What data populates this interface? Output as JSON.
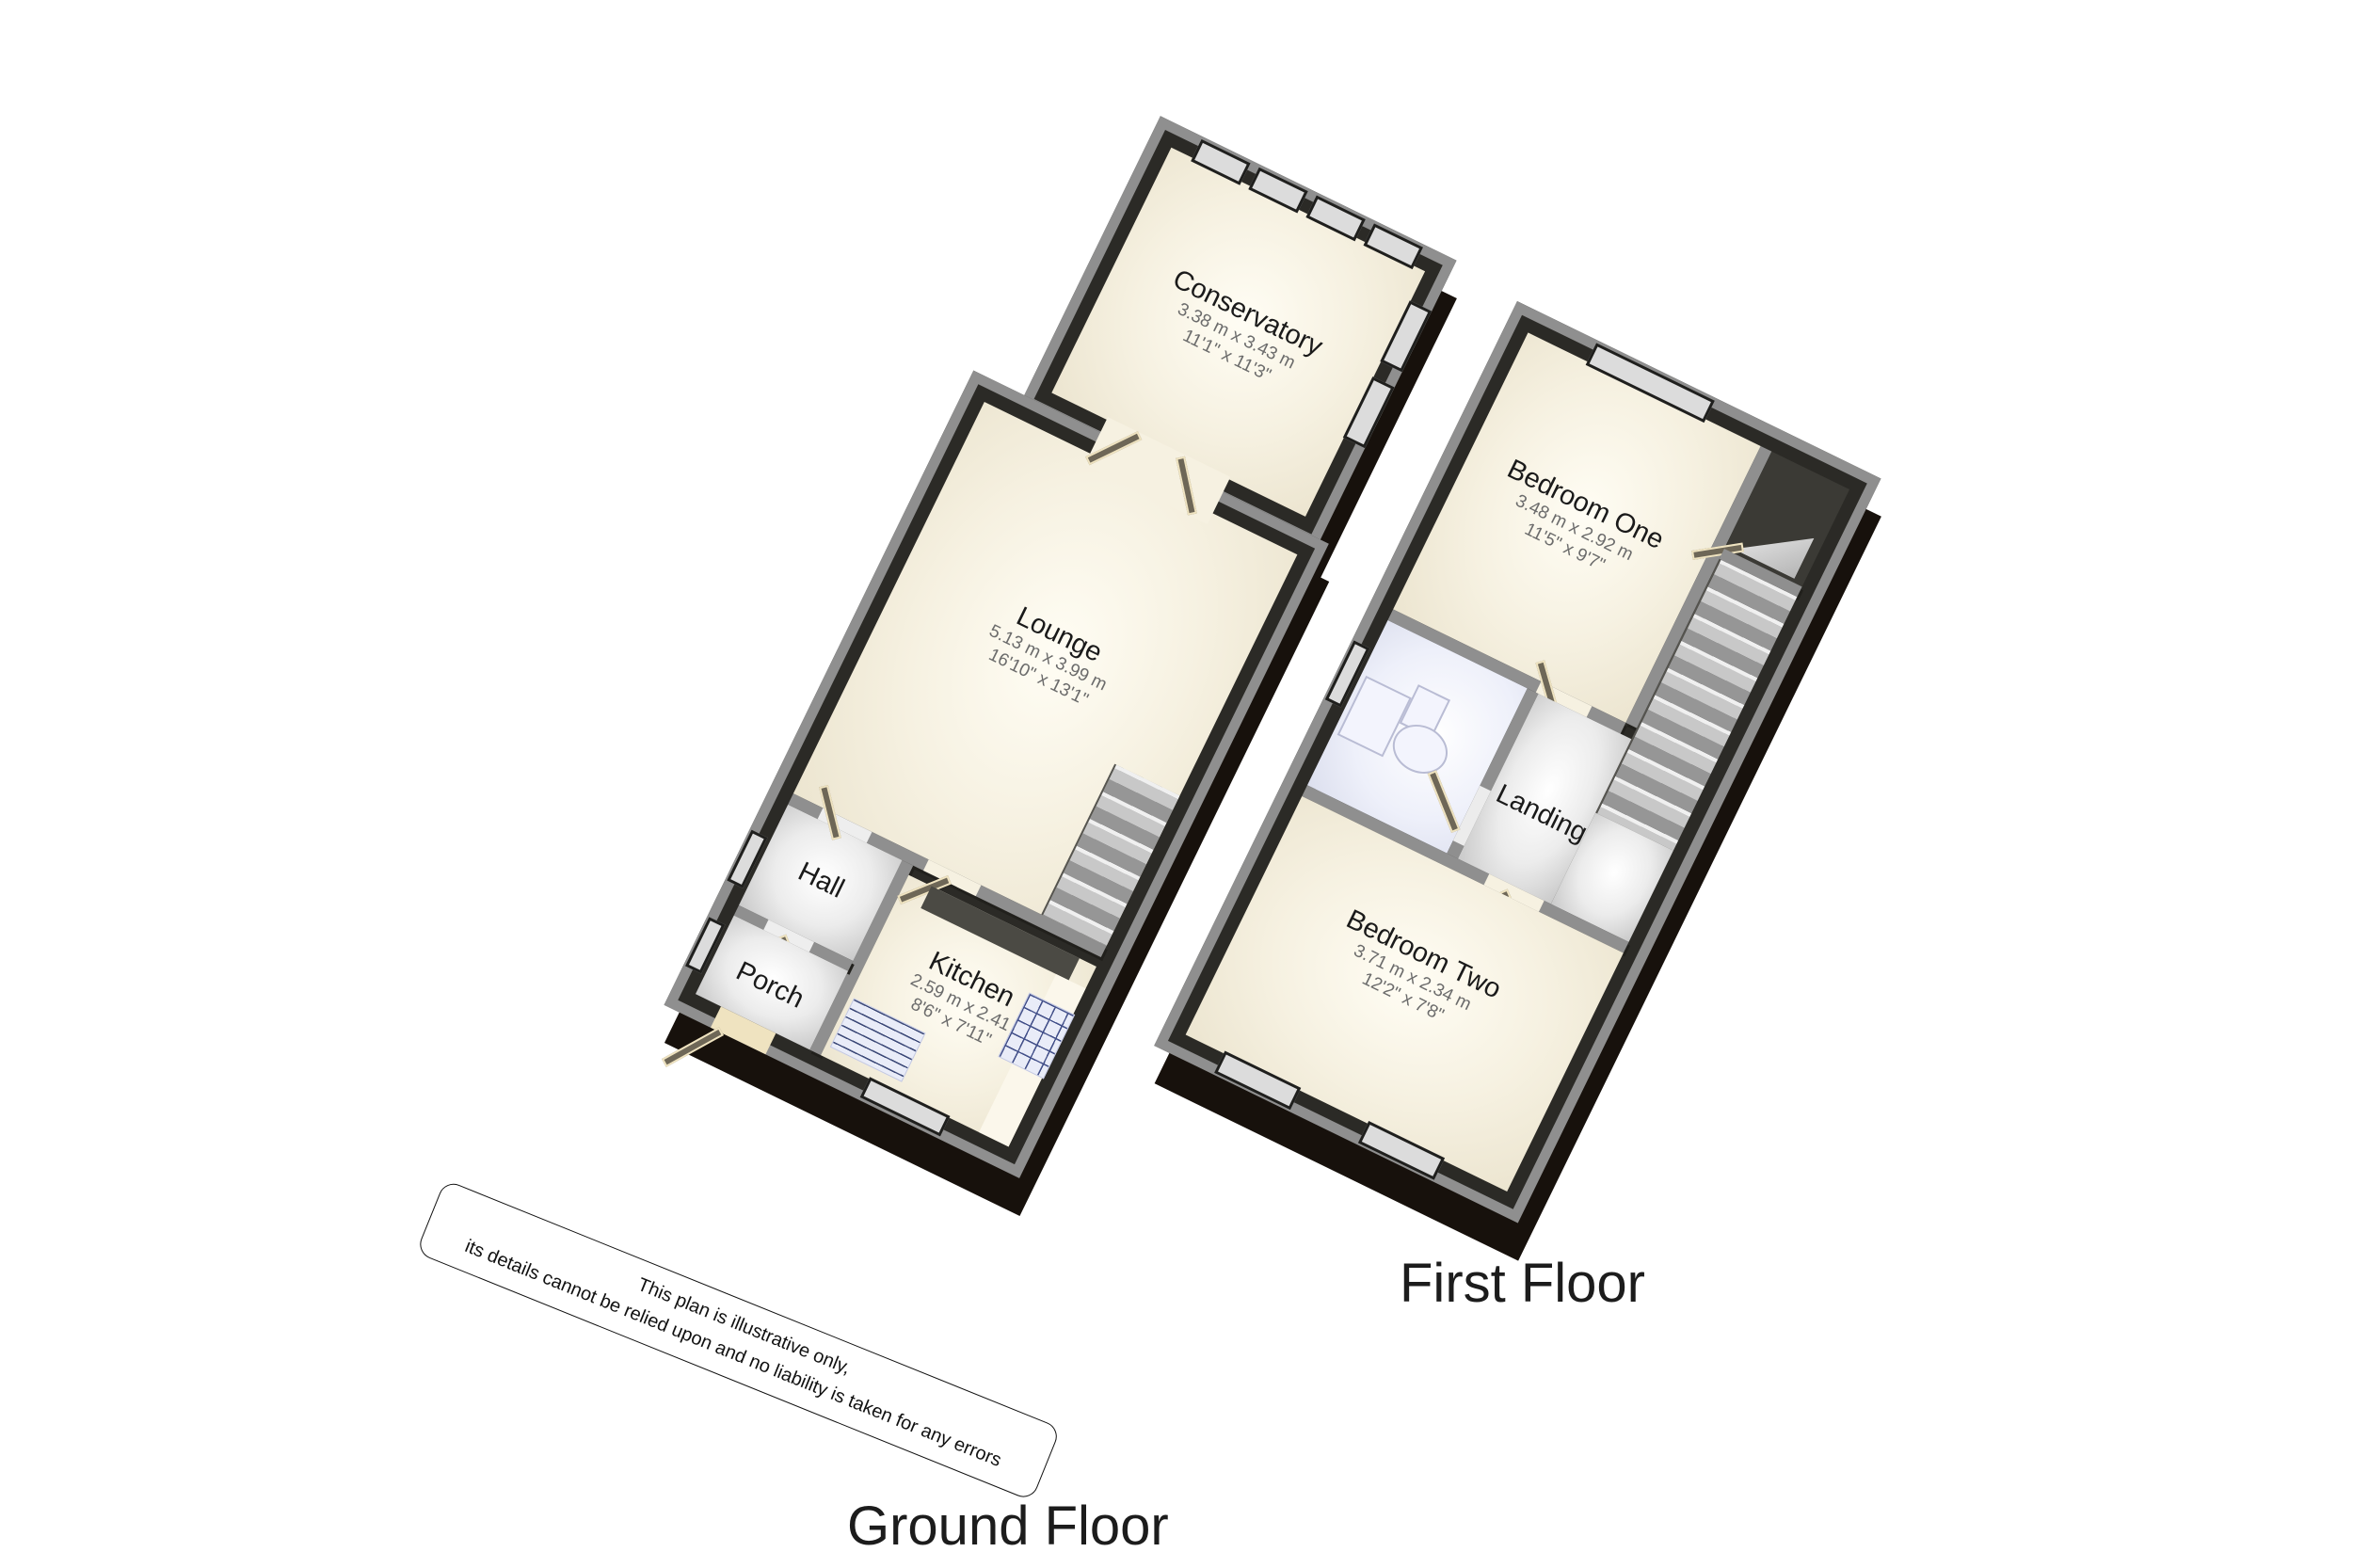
{
  "floors": {
    "ground": {
      "caption": "Ground Floor",
      "rooms": {
        "conservatory": {
          "name": "Conservatory",
          "metric": "3.38 m x 3.43 m",
          "imperial": "11'1\" x 11'3\""
        },
        "lounge": {
          "name": "Lounge",
          "metric": "5.13 m x 3.99 m",
          "imperial": "16'10\" x 13'1\""
        },
        "hall": {
          "name": "Hall"
        },
        "porch": {
          "name": "Porch"
        },
        "kitchen": {
          "name": "Kitchen",
          "metric": "2.59 m x 2.41",
          "imperial": "8'6\" x 7'11\""
        }
      }
    },
    "first": {
      "caption": "First Floor",
      "rooms": {
        "bedroom_one": {
          "name": "Bedroom One",
          "metric": "3.48 m x 2.92 m",
          "imperial": "11'5\" x 9'7\""
        },
        "landing": {
          "name": "Landing"
        },
        "bedroom_two": {
          "name": "Bedroom Two",
          "metric": "3.71 m x 2.34 m",
          "imperial": "12'2\" x 7'8\""
        }
      }
    }
  },
  "disclaimer": {
    "line1": "This plan is illustrative only,",
    "line2": "its details cannot be relied upon and no liability is taken for any errors"
  },
  "colors": {
    "background": "#ffffff",
    "wall_cap": "#8f8f8f",
    "wall_face": "#2b2a26",
    "base_extrusion": "#17110c",
    "floor_cream": "#f6f1e1",
    "floor_light": "#ececec",
    "bathroom_floor": "#eef0fa",
    "door_leaf": "#6e6757",
    "door_trim": "#efe3c0",
    "window_pane": "#dcdcdc",
    "stairs": "#c8c8c8",
    "appliance": "#e9ecf8",
    "room_text": "#1a1a1a",
    "dims_text": "#6b6b6b"
  }
}
